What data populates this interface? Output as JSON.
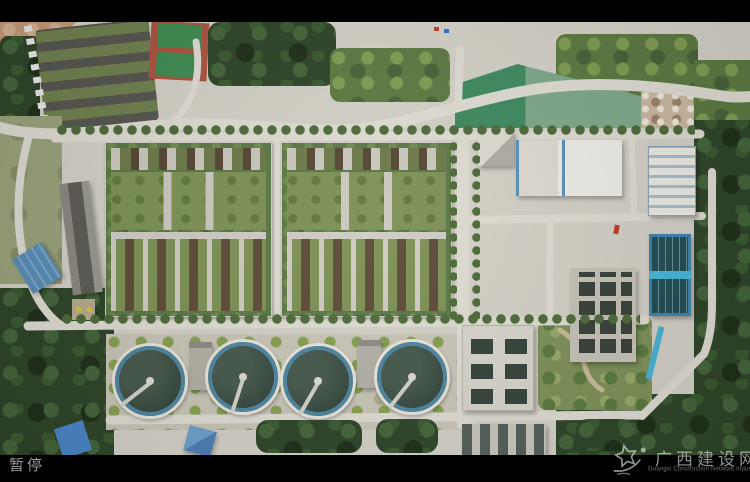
{
  "player": {
    "status_label": "暂停"
  },
  "watermark": {
    "logo_icon": "shooting-star-logo",
    "title": "广西建设网",
    "subtitle": "Guangxi Construction Network Industry Edition"
  },
  "scene": {
    "subject": "aerial-view-wastewater-treatment-plant",
    "colors": {
      "letterbox": "#000000",
      "status_text": "#9b9b9b",
      "watermark_text": "#eeeeee",
      "clarifier_water": "#3a4d43",
      "clarifier_rim": "#4e86a0",
      "filter_basin_walkway": "#49b7d8",
      "green_roof": "#7e9156",
      "road": "#dfdcd3"
    }
  }
}
